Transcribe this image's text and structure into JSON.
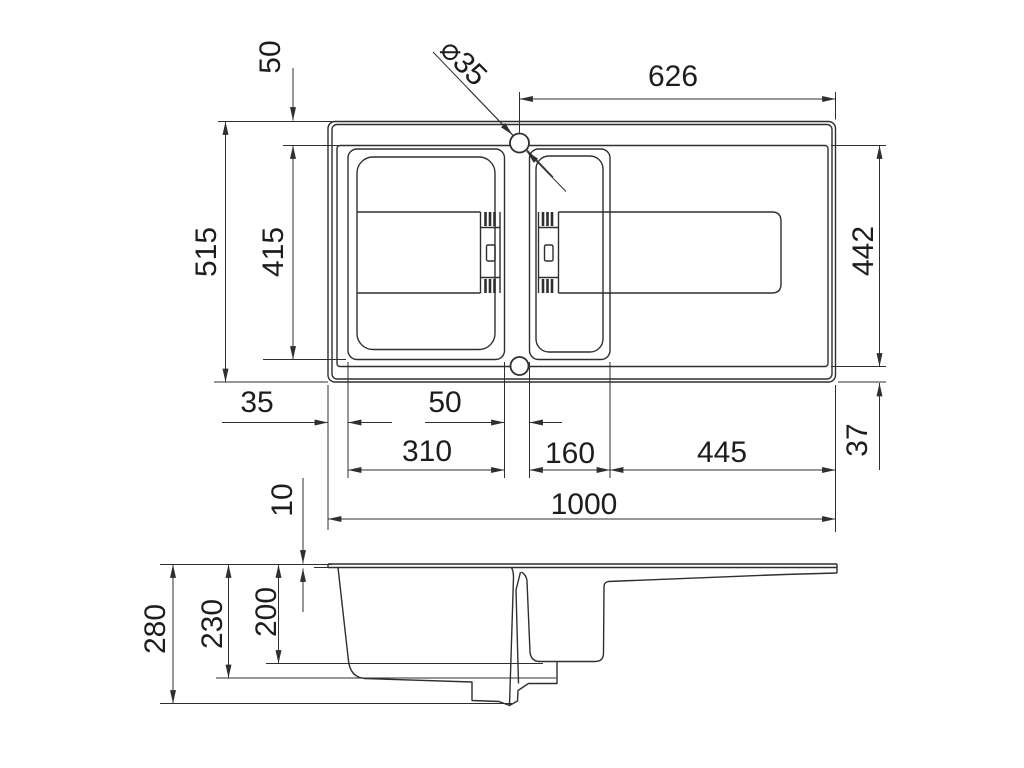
{
  "drawing": {
    "colors": {
      "background": "#ffffff",
      "line": "#2f2f2f",
      "text": "#1d1d1d"
    },
    "top_view": {
      "faucet_hole_diameter": "⌀35",
      "rim_to_bowl": "50",
      "hole_to_right_edge": "626",
      "overall_depth": "515",
      "bowl_front_to_back": "415",
      "inner_front_to_back": "442",
      "edge_to_bowl_left": "35",
      "between_bowls": "50",
      "main_bowl_width": "310",
      "half_bowl_width": "160",
      "drainboard_width": "445",
      "inner_to_edge_bottom": "37",
      "overall_width": "1000"
    },
    "side_view": {
      "rim_thickness": "10",
      "overall_height": "280",
      "main_bowl_depth": "230",
      "bowl_depth": "200"
    }
  }
}
